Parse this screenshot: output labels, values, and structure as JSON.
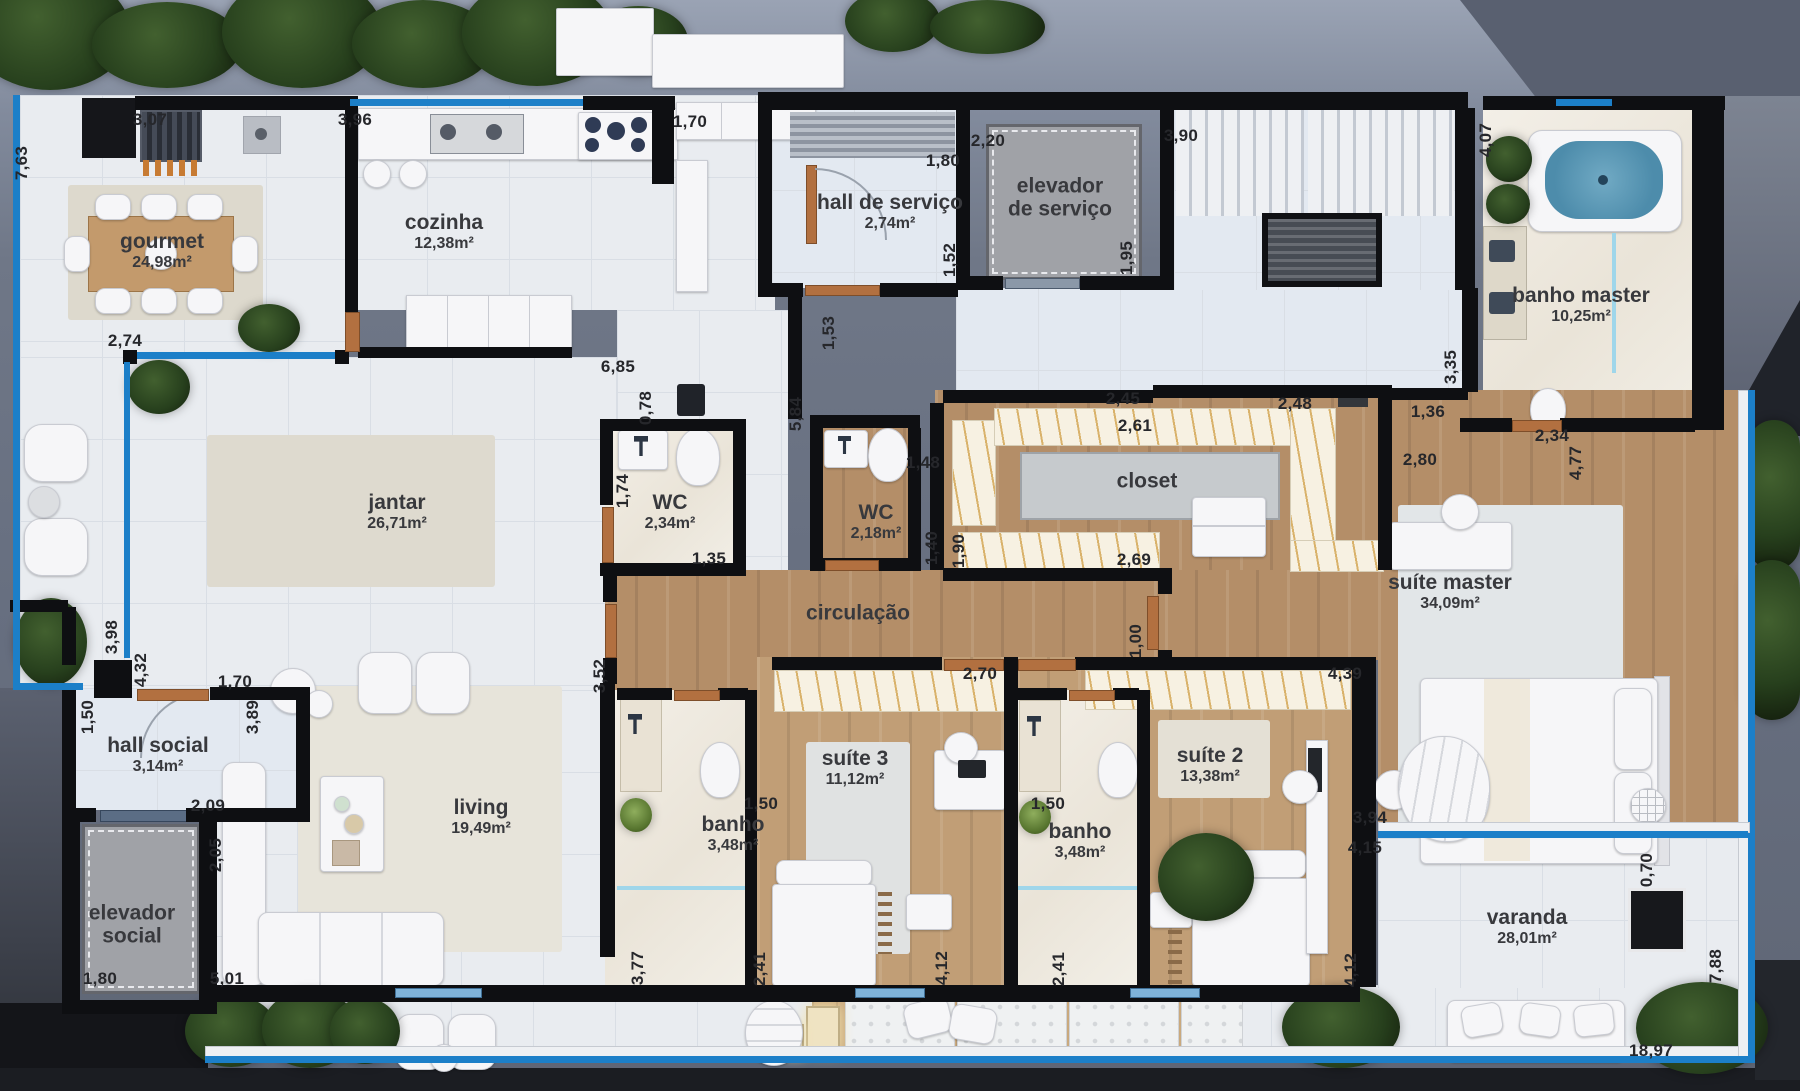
{
  "plan": {
    "title": "planta do apartamento",
    "colors": {
      "glass_blue": "#1c7fc8",
      "wall_black": "#0e0f12",
      "wood_floor": "#b48e68",
      "label_text": "#38393d",
      "dimension_text": "#26272b"
    },
    "rooms": [
      {
        "id": "gourmet",
        "name": "gourmet",
        "area": "24,98m²",
        "x": 162,
        "y": 251
      },
      {
        "id": "cozinha",
        "name": "cozinha",
        "area": "12,38m²",
        "x": 444,
        "y": 232
      },
      {
        "id": "hall-servico",
        "name": "hall de serviço",
        "area": "2,74m²",
        "x": 890,
        "y": 212
      },
      {
        "id": "elevador-servico",
        "lines": [
          "elevador",
          "de serviço"
        ],
        "x": 1060,
        "y": 198
      },
      {
        "id": "banho-master",
        "name": "banho master",
        "area": "10,25m²",
        "x": 1581,
        "y": 305
      },
      {
        "id": "jantar",
        "name": "jantar",
        "area": "26,71m²",
        "x": 397,
        "y": 512
      },
      {
        "id": "wc-1",
        "name": "WC",
        "area": "2,34m²",
        "x": 670,
        "y": 512
      },
      {
        "id": "wc-2",
        "name": "WC",
        "area": "2,18m²",
        "x": 876,
        "y": 522
      },
      {
        "id": "closet",
        "name": "closet",
        "x": 1147,
        "y": 482
      },
      {
        "id": "circulacao",
        "name": "circulação",
        "x": 858,
        "y": 614
      },
      {
        "id": "suite-master",
        "name": "suíte master",
        "area": "34,09m²",
        "x": 1450,
        "y": 592
      },
      {
        "id": "hall-social",
        "name": "hall social",
        "area": "3,14m²",
        "x": 158,
        "y": 755
      },
      {
        "id": "elevador-social",
        "lines": [
          "elevador",
          "social"
        ],
        "x": 132,
        "y": 925
      },
      {
        "id": "living",
        "name": "living",
        "area": "19,49m²",
        "x": 481,
        "y": 817
      },
      {
        "id": "banho-3",
        "name": "banho",
        "area": "3,48m²",
        "x": 733,
        "y": 834
      },
      {
        "id": "suite-3",
        "name": "suíte 3",
        "area": "11,12m²",
        "x": 855,
        "y": 768
      },
      {
        "id": "banho-2",
        "name": "banho",
        "area": "3,48m²",
        "x": 1080,
        "y": 841
      },
      {
        "id": "suite-2",
        "name": "suíte 2",
        "area": "13,38m²",
        "x": 1210,
        "y": 765
      },
      {
        "id": "varanda",
        "name": "varanda",
        "area": "28,01m²",
        "x": 1527,
        "y": 927
      }
    ],
    "dimensions": [
      {
        "v": "7,63",
        "x": 22,
        "y": 163,
        "r": 1
      },
      {
        "v": "3,07",
        "x": 150,
        "y": 120,
        "r": 0
      },
      {
        "v": "3,96",
        "x": 355,
        "y": 120,
        "r": 0
      },
      {
        "v": "1,70",
        "x": 690,
        "y": 122,
        "r": 0
      },
      {
        "v": "1,80",
        "x": 943,
        "y": 161,
        "r": 0
      },
      {
        "v": "2,20",
        "x": 988,
        "y": 141,
        "r": 0
      },
      {
        "v": "3,90",
        "x": 1181,
        "y": 136,
        "r": 0
      },
      {
        "v": "4,07",
        "x": 1486,
        "y": 140,
        "r": 1
      },
      {
        "v": "1,52",
        "x": 950,
        "y": 260,
        "r": 1
      },
      {
        "v": "1,95",
        "x": 1127,
        "y": 258,
        "r": 1
      },
      {
        "v": "2,74",
        "x": 125,
        "y": 341,
        "r": 0
      },
      {
        "v": "1,53",
        "x": 829,
        "y": 333,
        "r": 1
      },
      {
        "v": "6,85",
        "x": 618,
        "y": 367,
        "r": 0
      },
      {
        "v": "2,45",
        "x": 1123,
        "y": 399,
        "r": 0
      },
      {
        "v": "2,48",
        "x": 1295,
        "y": 404,
        "r": 0
      },
      {
        "v": "2,61",
        "x": 1135,
        "y": 426,
        "r": 0
      },
      {
        "v": "1,36",
        "x": 1428,
        "y": 412,
        "r": 0
      },
      {
        "v": "3,35",
        "x": 1451,
        "y": 367,
        "r": 1
      },
      {
        "v": "2,34",
        "x": 1552,
        "y": 436,
        "r": 0
      },
      {
        "v": "2,80",
        "x": 1420,
        "y": 460,
        "r": 0
      },
      {
        "v": "4,77",
        "x": 1576,
        "y": 463,
        "r": 1
      },
      {
        "v": "0,78",
        "x": 646,
        "y": 408,
        "r": 1
      },
      {
        "v": "5,84",
        "x": 796,
        "y": 414,
        "r": 1
      },
      {
        "v": "1,74",
        "x": 623,
        "y": 491,
        "r": 1
      },
      {
        "v": "1,48",
        "x": 923,
        "y": 463,
        "r": 0
      },
      {
        "v": "1,35",
        "x": 709,
        "y": 559,
        "r": 0
      },
      {
        "v": "1,40",
        "x": 932,
        "y": 548,
        "r": 1
      },
      {
        "v": "1,90",
        "x": 959,
        "y": 551,
        "r": 1
      },
      {
        "v": "2,69",
        "x": 1134,
        "y": 560,
        "r": 0
      },
      {
        "v": "1,00",
        "x": 1136,
        "y": 641,
        "r": 1
      },
      {
        "v": "3,98",
        "x": 112,
        "y": 637,
        "r": 1
      },
      {
        "v": "4,32",
        "x": 141,
        "y": 670,
        "r": 1
      },
      {
        "v": "1,70",
        "x": 235,
        "y": 682,
        "r": 0
      },
      {
        "v": "1,50",
        "x": 88,
        "y": 717,
        "r": 1
      },
      {
        "v": "3,89",
        "x": 253,
        "y": 717,
        "r": 1
      },
      {
        "v": "2,09",
        "x": 208,
        "y": 806,
        "r": 0
      },
      {
        "v": "2,05",
        "x": 216,
        "y": 855,
        "r": 1
      },
      {
        "v": "1,80",
        "x": 100,
        "y": 979,
        "r": 0
      },
      {
        "v": "5,01",
        "x": 227,
        "y": 979,
        "r": 0
      },
      {
        "v": "3,52",
        "x": 600,
        "y": 676,
        "r": 1
      },
      {
        "v": "2,70",
        "x": 980,
        "y": 674,
        "r": 0
      },
      {
        "v": "4,39",
        "x": 1345,
        "y": 674,
        "r": 0
      },
      {
        "v": "1,50",
        "x": 761,
        "y": 804,
        "r": 0
      },
      {
        "v": "1,50",
        "x": 1048,
        "y": 804,
        "r": 0
      },
      {
        "v": "3,94",
        "x": 1370,
        "y": 818,
        "r": 0
      },
      {
        "v": "4,15",
        "x": 1365,
        "y": 848,
        "r": 0
      },
      {
        "v": "0,70",
        "x": 1647,
        "y": 870,
        "r": 1
      },
      {
        "v": "3,77",
        "x": 638,
        "y": 968,
        "r": 1
      },
      {
        "v": "2,41",
        "x": 760,
        "y": 969,
        "r": 1
      },
      {
        "v": "4,12",
        "x": 942,
        "y": 968,
        "r": 1
      },
      {
        "v": "2,41",
        "x": 1059,
        "y": 969,
        "r": 1
      },
      {
        "v": "4,12",
        "x": 1351,
        "y": 970,
        "r": 1
      },
      {
        "v": "7,88",
        "x": 1716,
        "y": 966,
        "r": 1
      },
      {
        "v": "18,97",
        "x": 1651,
        "y": 1051,
        "r": 0
      }
    ]
  }
}
